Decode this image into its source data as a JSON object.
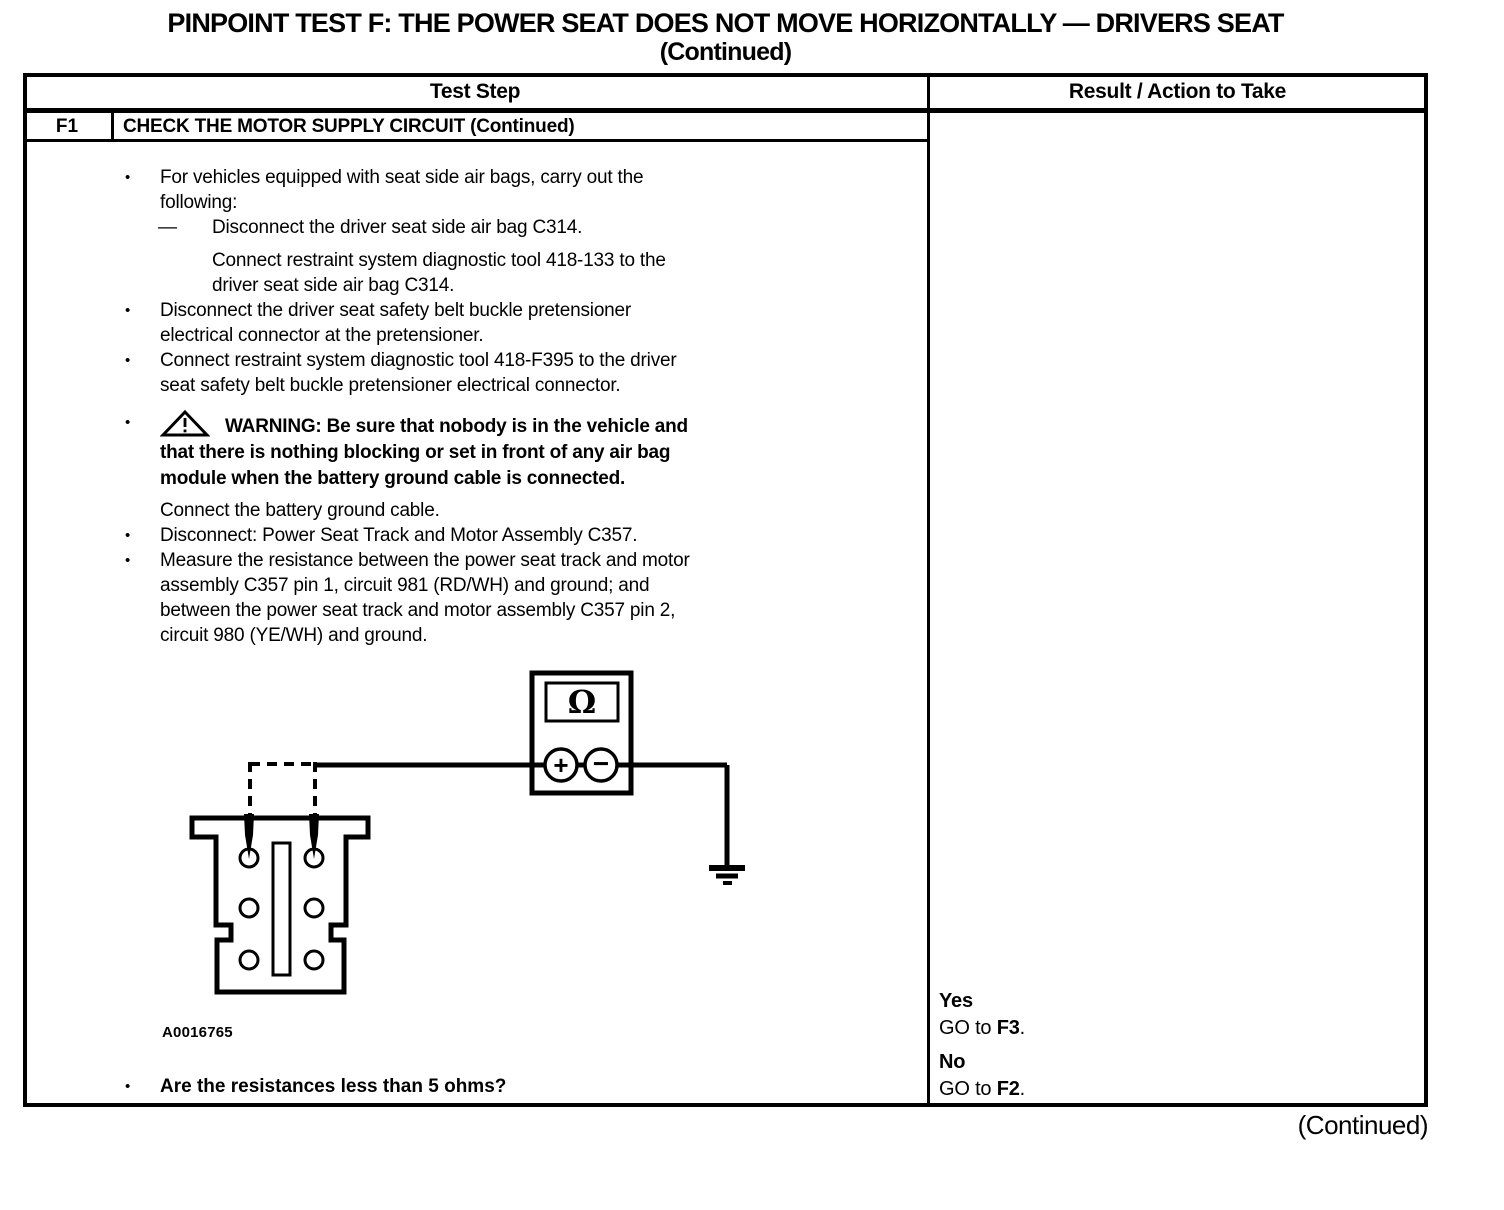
{
  "colors": {
    "ink": "#000000",
    "paper": "#ffffff"
  },
  "glyphs": {
    "bullet": "•"
  },
  "title": {
    "line1": "PINPOINT TEST F: THE POWER SEAT DOES NOT MOVE HORIZONTALLY — DRIVERS SEAT",
    "line2": "(Continued)"
  },
  "table": {
    "columns": {
      "test_step": "Test Step",
      "result_action": "Result / Action to Take"
    },
    "step_id": "F1",
    "step_title": "CHECK THE MOTOR SUPPLY CIRCUIT (Continued)",
    "instructions": [
      {
        "type": "bullet",
        "text": "For vehicles equipped with seat side air bags, carry out the\nfollowing:"
      },
      {
        "type": "dash",
        "marker": "—",
        "text": "Disconnect the driver seat side air bag C314."
      },
      {
        "type": "sub",
        "text": "Connect restraint system diagnostic tool 418-133 to the\ndriver seat side air bag C314."
      },
      {
        "type": "bullet",
        "text": "Disconnect the driver seat safety belt buckle pretensioner\nelectrical connector at the pretensioner."
      },
      {
        "type": "bullet",
        "text": "Connect restraint system diagnostic tool 418-F395 to the driver\nseat safety belt buckle pretensioner electrical connector."
      },
      {
        "type": "warning",
        "text": "WARNING: Be sure that nobody is in the vehicle and\nthat there is nothing blocking or set in front of any air bag\nmodule when the battery ground cable is connected."
      },
      {
        "type": "plain",
        "text": "Connect the battery ground cable."
      },
      {
        "type": "bullet",
        "text": "Disconnect: Power Seat Track and Motor Assembly C357."
      },
      {
        "type": "bullet",
        "text": "Measure the resistance between the power seat track and motor\nassembly C357 pin 1, circuit 981 (RD/WH) and ground; and\nbetween the power seat track and motor assembly C357 pin 2,\ncircuit 980 (YE/WH) and ground."
      }
    ],
    "diagram": {
      "meter_display": "Ω",
      "positive_terminal": "+",
      "negative_terminal": "−",
      "figure_label": "A0016765"
    },
    "question": "Are the resistances less than 5 ohms?",
    "results": [
      {
        "verdict": "Yes",
        "action_prefix": "GO to ",
        "action_target": "F3",
        "action_suffix": "."
      },
      {
        "verdict": "No",
        "action_prefix": "GO to ",
        "action_target": "F2",
        "action_suffix": "."
      }
    ]
  },
  "footer": {
    "continued": "(Continued)"
  }
}
